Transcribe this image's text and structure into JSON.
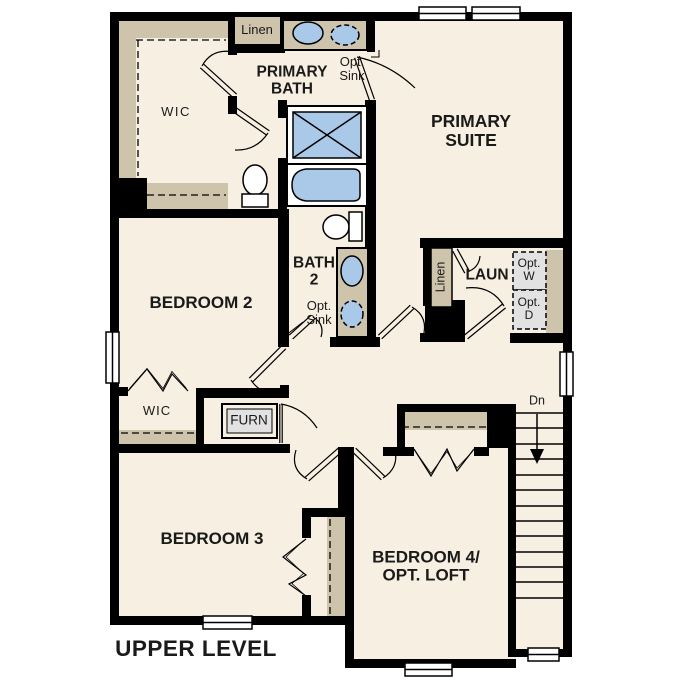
{
  "plan_title": "UPPER LEVEL",
  "colors": {
    "background": "#ffffff",
    "floor": "#f7efe2",
    "walls": "#000000",
    "cabinetry_tan": "#cec3ab",
    "fixture_blue": "#aac9e8",
    "equipment_gray": "#e2e2e2"
  },
  "rooms": {
    "primary_suite": {
      "line1": "PRIMARY",
      "line2": "SUITE"
    },
    "primary_bath": {
      "line1": "PRIMARY",
      "line2": "BATH"
    },
    "bedroom_2": {
      "label": "BEDROOM 2"
    },
    "bath_2": {
      "line1": "BATH",
      "line2": "2"
    },
    "laundry": {
      "label": "LAUN"
    },
    "bedroom_3": {
      "label": "BEDROOM 3"
    },
    "bedroom_4": {
      "line1": "BEDROOM 4/",
      "line2": "OPT. LOFT"
    },
    "wic_primary": {
      "label": "WIC"
    },
    "wic_bedroom_2": {
      "label": "WIC"
    }
  },
  "closets": {
    "linen_primary_bath": {
      "label": "Linen"
    },
    "linen_laundry": {
      "label": "Linen"
    }
  },
  "fixtures": {
    "furnace": {
      "label": "FURN"
    },
    "opt_sink_primary": {
      "line1": "Opt.",
      "line2": "Sink"
    },
    "opt_sink_bath2": {
      "line1": "Opt.",
      "line2": "Sink"
    },
    "opt_washer": {
      "line1": "Opt.",
      "line2": "W"
    },
    "opt_dryer": {
      "line1": "Opt.",
      "line2": "D"
    }
  },
  "stairs": {
    "direction_label": "Dn",
    "tread_count": 13
  }
}
